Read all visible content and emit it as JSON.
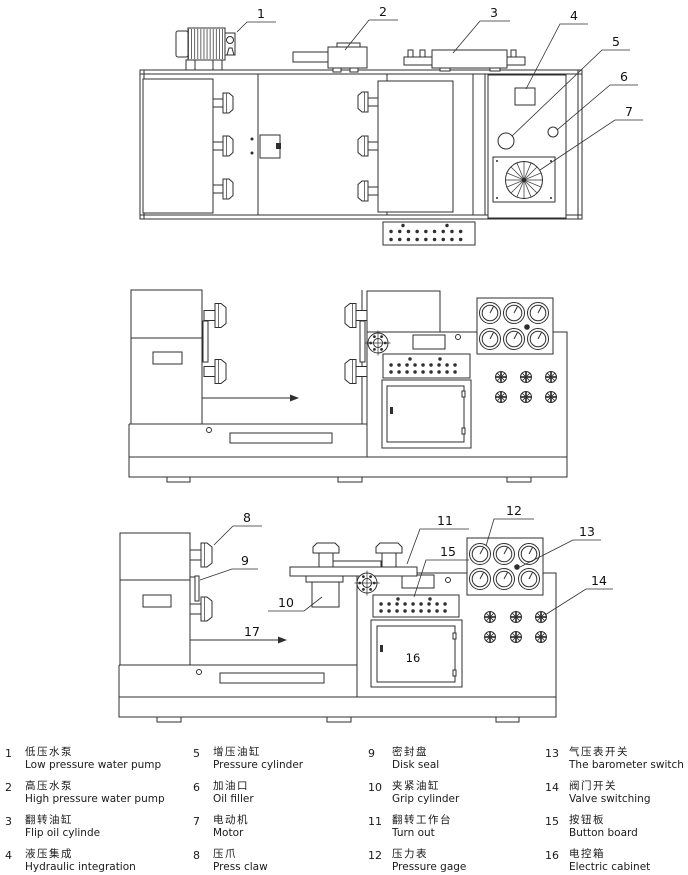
{
  "figure": {
    "callouts": {
      "c1": "1",
      "c2": "2",
      "c3": "3",
      "c4": "4",
      "c5": "5",
      "c6": "6",
      "c7": "7",
      "c8": "8",
      "c9": "9",
      "c10": "10",
      "c11": "11",
      "c12": "12",
      "c13": "13",
      "c14": "14",
      "c15": "15",
      "c16": "16",
      "c17": "17"
    }
  },
  "legend": {
    "items": [
      {
        "no": "1",
        "zh": "低压水泵",
        "en": "Low pressure water pump"
      },
      {
        "no": "2",
        "zh": "高压水泵",
        "en": "High pressure water pump"
      },
      {
        "no": "3",
        "zh": "翻转油缸",
        "en": "Flip oil cylinde"
      },
      {
        "no": "4",
        "zh": "液压集成",
        "en": "Hydraulic integration"
      },
      {
        "no": "5",
        "zh": "增压油缸",
        "en": "Pressure cylinder"
      },
      {
        "no": "6",
        "zh": "加油口",
        "en": "Oil filler"
      },
      {
        "no": "7",
        "zh": "电动机",
        "en": "Motor"
      },
      {
        "no": "8",
        "zh": "压爪",
        "en": "Press claw"
      },
      {
        "no": "9",
        "zh": "密封盘",
        "en": "Disk seal"
      },
      {
        "no": "10",
        "zh": "夹紧油缸",
        "en": "Grip cylinder"
      },
      {
        "no": "11",
        "zh": "翻转工作台",
        "en": "Turn out"
      },
      {
        "no": "12",
        "zh": "压力表",
        "en": "Pressure gage"
      },
      {
        "no": "13",
        "zh": "气压表开关",
        "en": "The barometer switch"
      },
      {
        "no": "14",
        "zh": "阀门开关",
        "en": "Valve switching"
      },
      {
        "no": "15",
        "zh": "按钮板",
        "en": "Button board"
      },
      {
        "no": "16",
        "zh": "电控箱",
        "en": "Electric cabinet"
      }
    ]
  },
  "colors": {
    "line": "#2f2f2f",
    "background": "#ffffff"
  }
}
